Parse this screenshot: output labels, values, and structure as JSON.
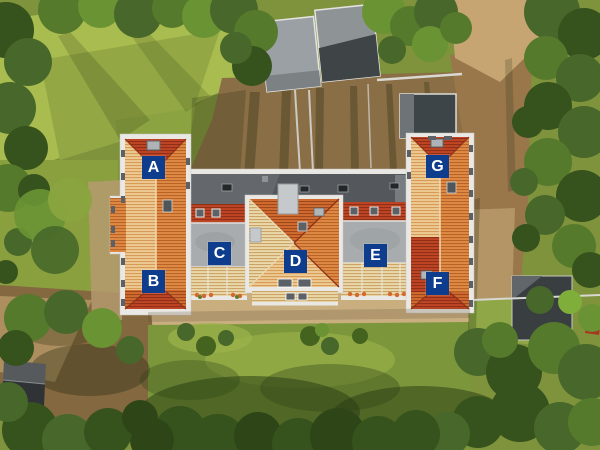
{
  "scene": {
    "type": "aerial-drone-photo",
    "subject": "H-shaped residential building complex with orange tiled roofs, unit markers A-G, surrounded by lawns, dirt paths and trees"
  },
  "markers": [
    {
      "letter": "A"
    },
    {
      "letter": "B"
    },
    {
      "letter": "C"
    },
    {
      "letter": "D"
    },
    {
      "letter": "E"
    },
    {
      "letter": "F"
    },
    {
      "letter": "G"
    }
  ],
  "colors": {
    "marker_bg": "#0e3d8d",
    "marker_text": "#ffffff",
    "roof_tile_orange": "#d06c2f",
    "roof_ridge_red": "#bf4526",
    "flat_roof_gray": "#a8acae",
    "rear_roof_dark_gray": "#54585c",
    "facade_white": "#e9e8e4",
    "grass_green": "#7f923c",
    "tree_dark_green": "#36521d",
    "dirt_brown": "#8a6e45",
    "sand_tan": "#c9ae80"
  }
}
